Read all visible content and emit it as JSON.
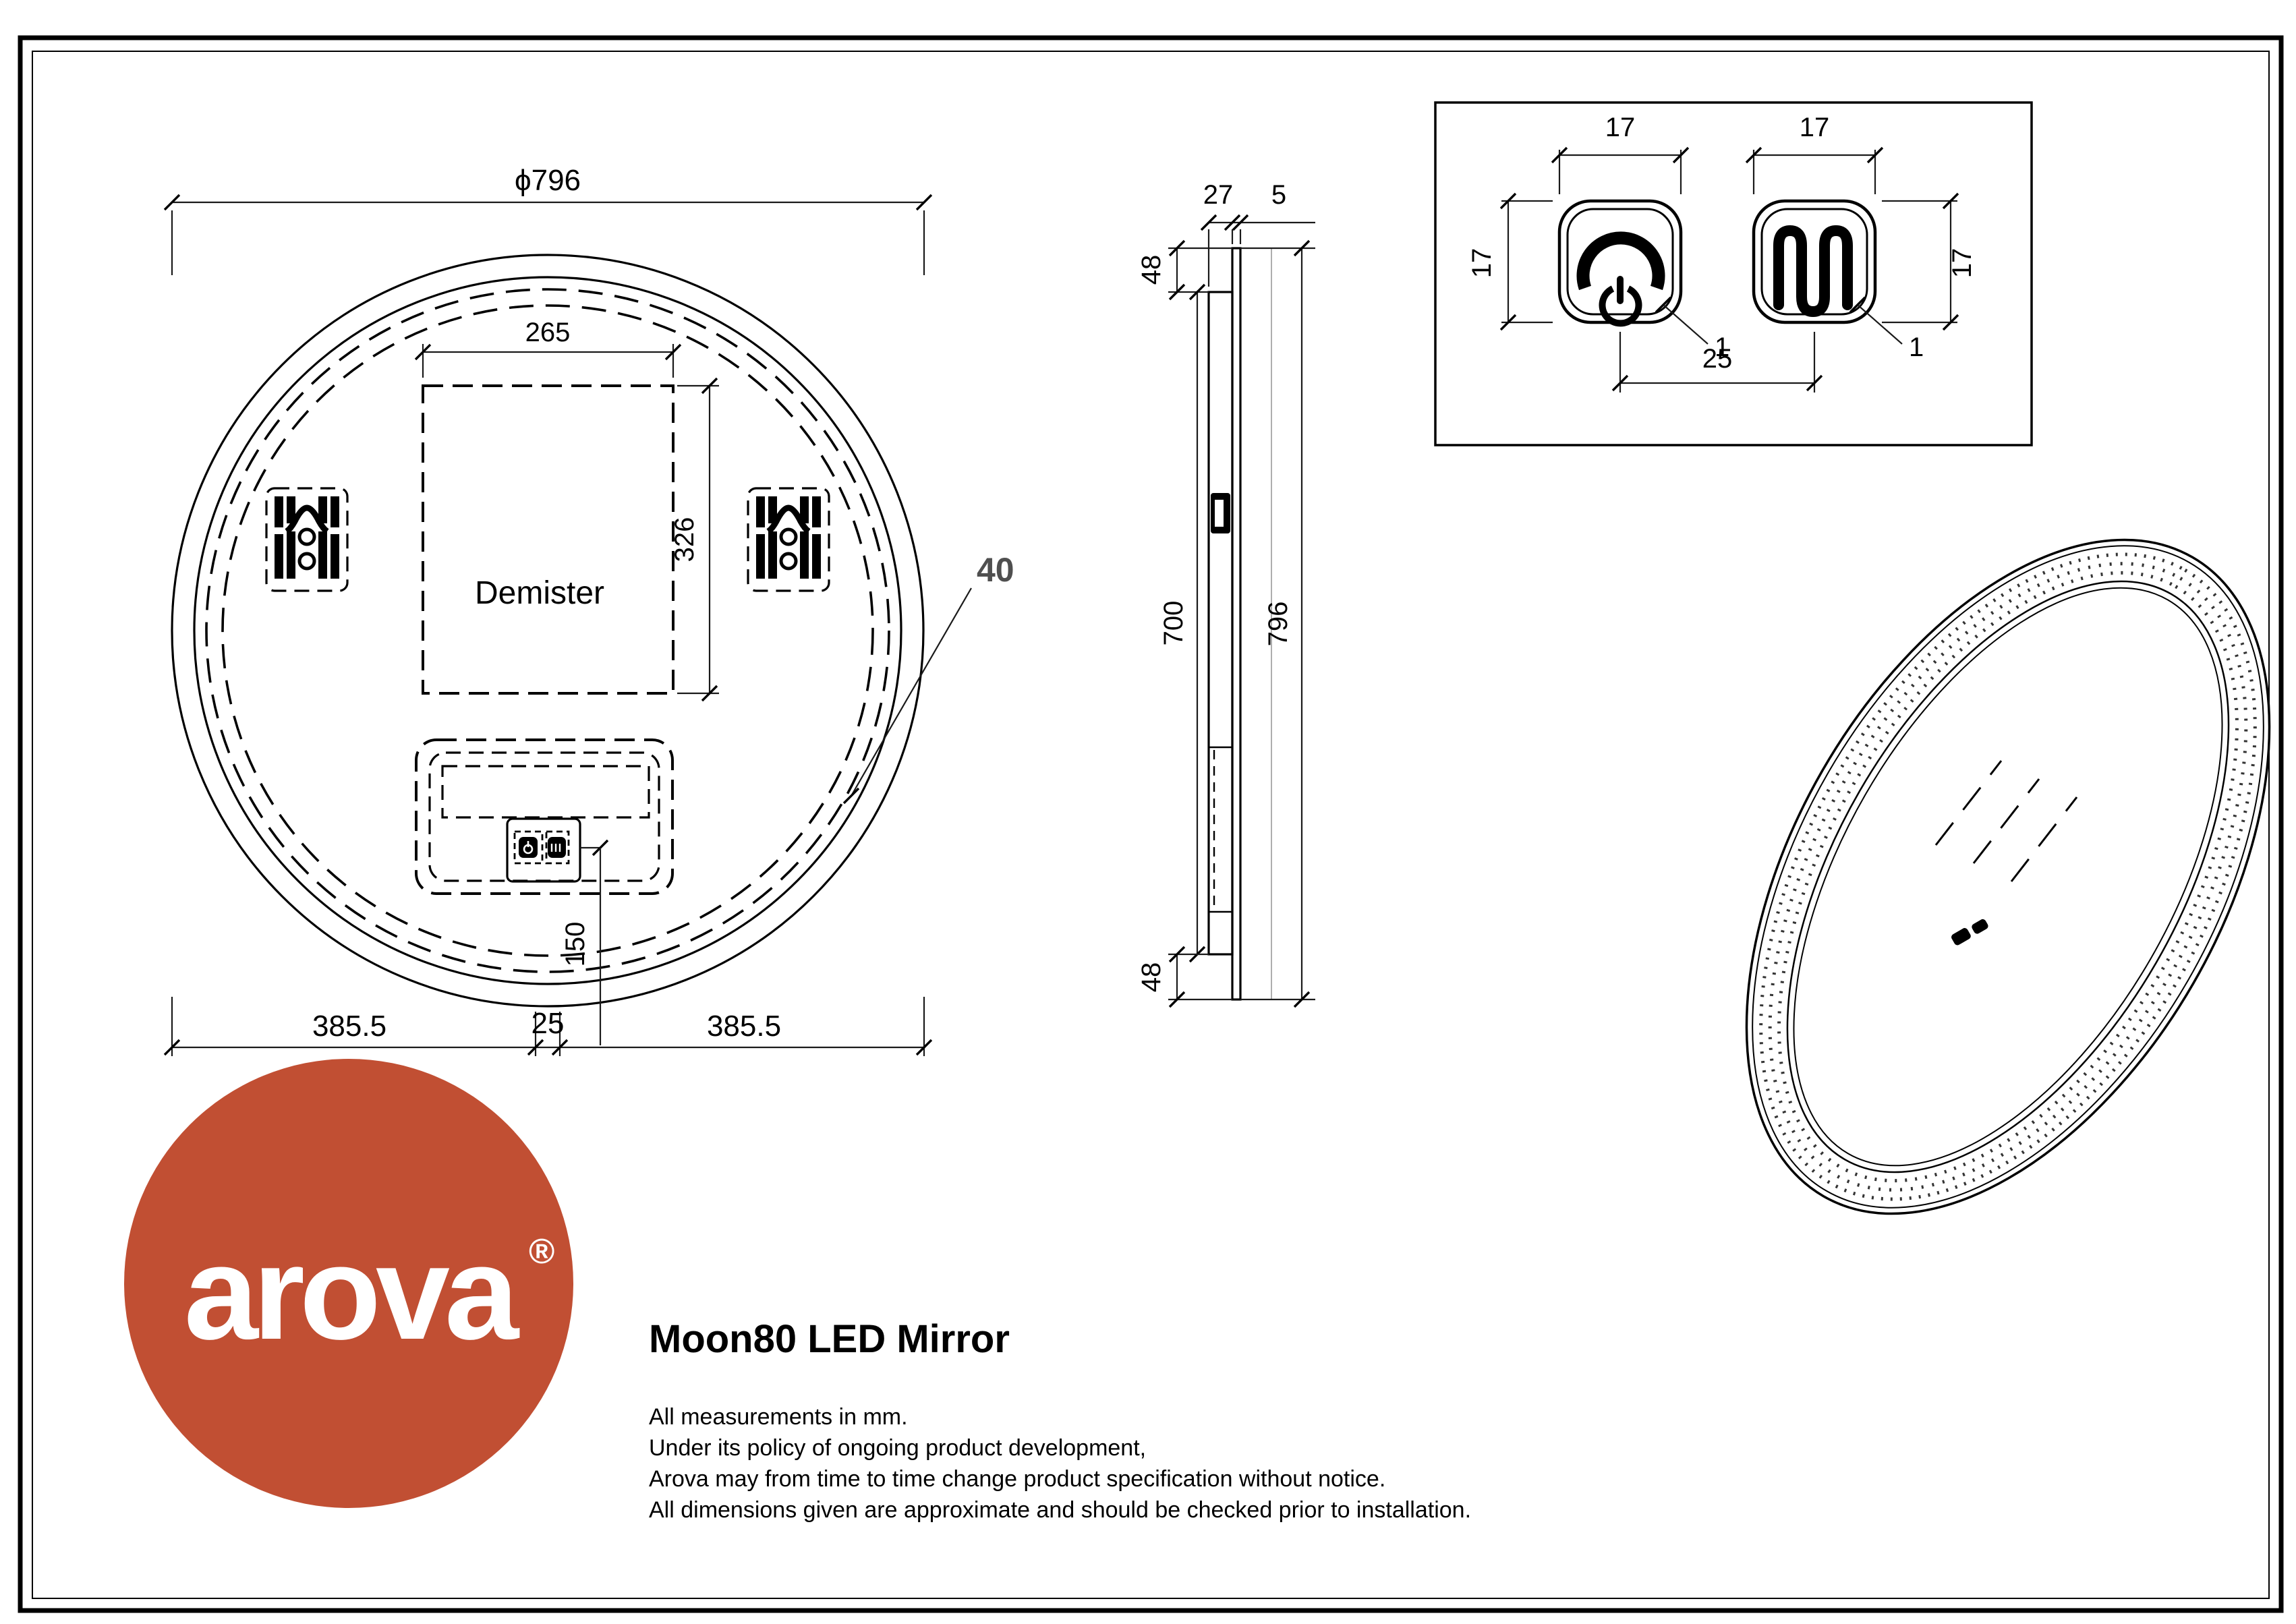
{
  "front_view": {
    "diameter": "ϕ796",
    "demister_width": "265",
    "demister_height": "326",
    "demister_label": "Demister",
    "frame_band": "40",
    "sensor_offset": "150",
    "bottom_left": "385.5",
    "bottom_center": "25",
    "bottom_right": "385.5"
  },
  "side_view": {
    "depth": "27",
    "glass": "5",
    "top_offset": "48",
    "body_height": "700",
    "total_height": "796",
    "bottom_offset": "48"
  },
  "detail_view": {
    "button1_width": "17",
    "button2_width": "17",
    "button1_height": "17",
    "button2_height": "17",
    "spacing": "25",
    "corner1": "1",
    "corner2": "1"
  },
  "logo": {
    "brand": "arova",
    "registered": "®",
    "color": "#c14f33"
  },
  "title": "Moon80 LED Mirror",
  "notes": [
    "All measurements in mm.",
    "Under its policy of ongoing product development,",
    "Arova may from time to time change product specification without notice.",
    "All dimensions given are approximate and should be checked prior to installation."
  ]
}
